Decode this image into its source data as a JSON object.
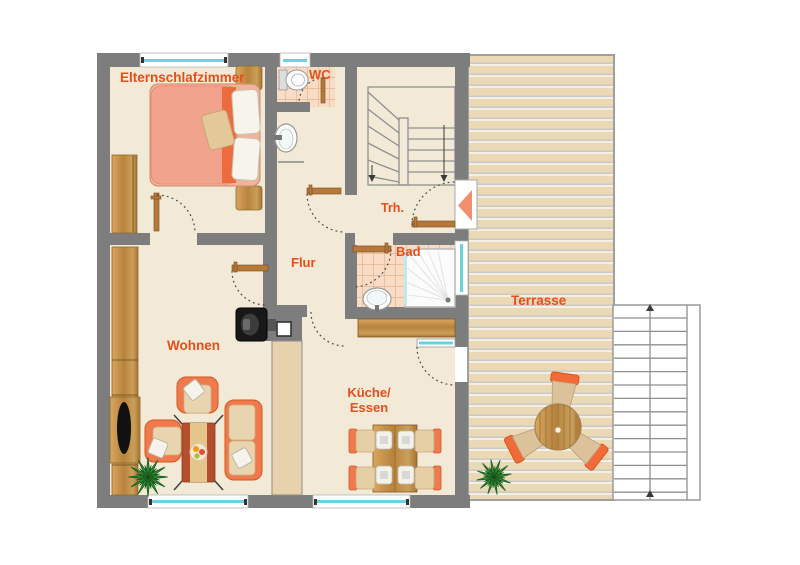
{
  "rooms": {
    "bedroom": {
      "label": "Elternschlafzimmer"
    },
    "wc": {
      "label": "WC"
    },
    "stairwell": {
      "label": "Trh."
    },
    "hall": {
      "label": "Flur"
    },
    "bath": {
      "label": "Bad"
    },
    "living": {
      "label": "Wohnen"
    },
    "kitchen": {
      "label_line1": "Küche/",
      "label_line2": "Essen"
    },
    "terrace": {
      "label": "Terrasse"
    }
  },
  "colors": {
    "label_text": "#e84e1b",
    "wall": "#7d7d7d",
    "floor": "#f2e9d6",
    "bath_tile": "#f8dcc6",
    "wood": "#c08b45",
    "furniture_orange": "#ef7a4e",
    "cushion_beige": "#e8d4ae",
    "bed_duvet": "#f2a38e",
    "window_glass": "#66d4e2",
    "terrace_band": "#ebd9b6",
    "plant_green": "#2f8f35",
    "entrance_arrow": "#f28e6e"
  },
  "furniture": [
    "double-bed",
    "nightstand",
    "wardrobe",
    "sideboard-tv",
    "fireplace-stove",
    "chimney",
    "armchair",
    "sofa",
    "coffee-table",
    "fruit-bowl",
    "dining-table",
    "dining-chair",
    "kitchen-counter",
    "washbasin",
    "toilet",
    "shower",
    "terrace-table",
    "terrace-chair",
    "potted-plant",
    "interior-staircase",
    "outdoor-staircase"
  ],
  "doors": [
    "bedroom-door",
    "wc-door",
    "vestibule-door",
    "hall-living-door",
    "bath-door",
    "kitchen-passage",
    "terrace-door",
    "entrance-door"
  ],
  "windows_count": 5
}
